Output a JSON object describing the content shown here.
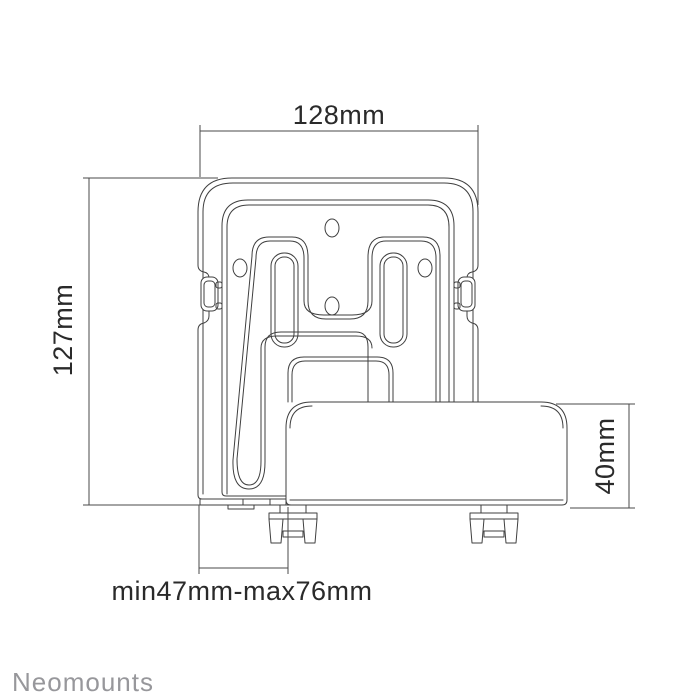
{
  "drawing": {
    "title": "Neomounts media player wall mount - dimension drawing",
    "view": "front view technical line drawing",
    "background_color": "#ffffff",
    "line_color": "#3f3f3f",
    "dimension_text_color": "#2a2a2a",
    "logo_color": "#97979b"
  },
  "dimensions": {
    "top_width": "128mm",
    "left_height": "127mm",
    "right_height": "40mm",
    "bottom_depth": "min47mm-max76mm"
  },
  "logo": {
    "text": "Neomounts"
  }
}
